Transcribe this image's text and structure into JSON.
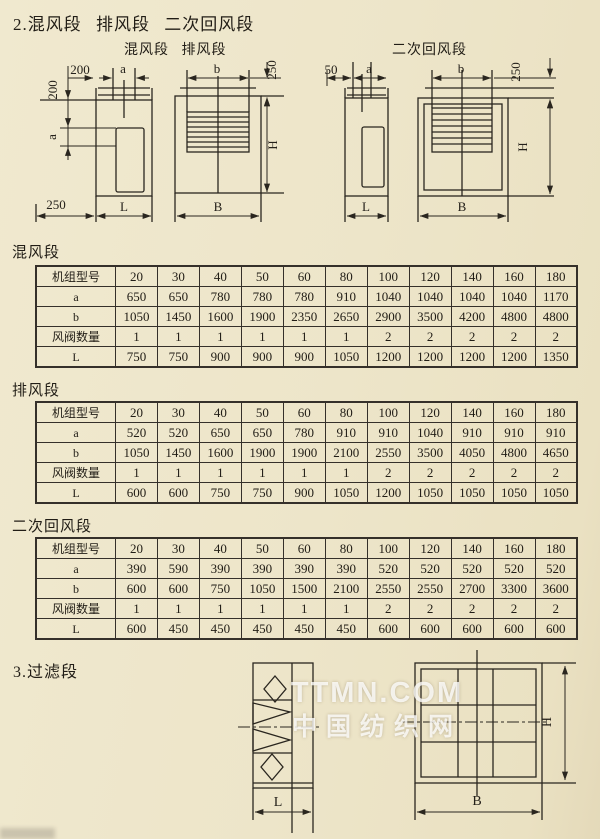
{
  "headings": {
    "section2": "2.混风段 排风段 二次回风段",
    "section3": "3.过滤段"
  },
  "diagrams": {
    "top_left": {
      "caption": "混风段 排风段",
      "offset_top": "200",
      "a_top": "a",
      "offset_left": "200",
      "a_left": "a",
      "offset_bottom": "250",
      "L": "L",
      "b": "b",
      "offset_right": "250",
      "H": "H",
      "B": "B"
    },
    "top_right": {
      "caption": "二次回风段",
      "offset_top": "50",
      "a_top": "a",
      "L": "L",
      "b": "b",
      "offset_right": "250",
      "H": "H",
      "B": "B"
    },
    "bottom": {
      "L": "L",
      "B": "B",
      "H": "H"
    }
  },
  "tables": [
    {
      "section_label": "混风段",
      "header": [
        "机组型号",
        "20",
        "30",
        "40",
        "50",
        "60",
        "80",
        "100",
        "120",
        "140",
        "160",
        "180"
      ],
      "rows": [
        {
          "label": "a",
          "values": [
            "650",
            "650",
            "780",
            "780",
            "780",
            "910",
            "1040",
            "1040",
            "1040",
            "1040",
            "1170"
          ]
        },
        {
          "label": "b",
          "values": [
            "1050",
            "1450",
            "1600",
            "1900",
            "2350",
            "2650",
            "2900",
            "3500",
            "4200",
            "4800",
            "4800"
          ]
        },
        {
          "label": "风阀数量",
          "values": [
            "1",
            "1",
            "1",
            "1",
            "1",
            "1",
            "2",
            "2",
            "2",
            "2",
            "2"
          ]
        },
        {
          "label": "L",
          "values": [
            "750",
            "750",
            "900",
            "900",
            "900",
            "1050",
            "1200",
            "1200",
            "1200",
            "1200",
            "1350"
          ]
        }
      ]
    },
    {
      "section_label": "排风段",
      "header": [
        "机组型号",
        "20",
        "30",
        "40",
        "50",
        "60",
        "80",
        "100",
        "120",
        "140",
        "160",
        "180"
      ],
      "rows": [
        {
          "label": "a",
          "values": [
            "520",
            "520",
            "650",
            "650",
            "780",
            "910",
            "910",
            "1040",
            "910",
            "910",
            "910"
          ]
        },
        {
          "label": "b",
          "values": [
            "1050",
            "1450",
            "1600",
            "1900",
            "1900",
            "2100",
            "2550",
            "3500",
            "4050",
            "4800",
            "4650"
          ]
        },
        {
          "label": "风阀数量",
          "values": [
            "1",
            "1",
            "1",
            "1",
            "1",
            "1",
            "2",
            "2",
            "2",
            "2",
            "2"
          ]
        },
        {
          "label": "L",
          "values": [
            "600",
            "600",
            "750",
            "750",
            "900",
            "1050",
            "1200",
            "1050",
            "1050",
            "1050",
            "1050"
          ]
        }
      ]
    },
    {
      "section_label": "二次回风段",
      "header": [
        "机组型号",
        "20",
        "30",
        "40",
        "50",
        "60",
        "80",
        "100",
        "120",
        "140",
        "160",
        "180"
      ],
      "rows": [
        {
          "label": "a",
          "values": [
            "390",
            "590",
            "390",
            "390",
            "390",
            "390",
            "520",
            "520",
            "520",
            "520",
            "520"
          ]
        },
        {
          "label": "b",
          "values": [
            "600",
            "600",
            "750",
            "1050",
            "1500",
            "2100",
            "2550",
            "2550",
            "2700",
            "3300",
            "3600"
          ]
        },
        {
          "label": "风阀数量",
          "values": [
            "1",
            "1",
            "1",
            "1",
            "1",
            "1",
            "2",
            "2",
            "2",
            "2",
            "2"
          ]
        },
        {
          "label": "L",
          "values": [
            "600",
            "450",
            "450",
            "450",
            "450",
            "450",
            "600",
            "600",
            "600",
            "600",
            "600"
          ]
        }
      ]
    }
  ],
  "watermark": {
    "line1": "TTMN.COM",
    "line2": "中国纺织网"
  },
  "colors": {
    "paper": "#ede5c9",
    "ink": "#2a261f",
    "watermark": "#ffffff"
  }
}
